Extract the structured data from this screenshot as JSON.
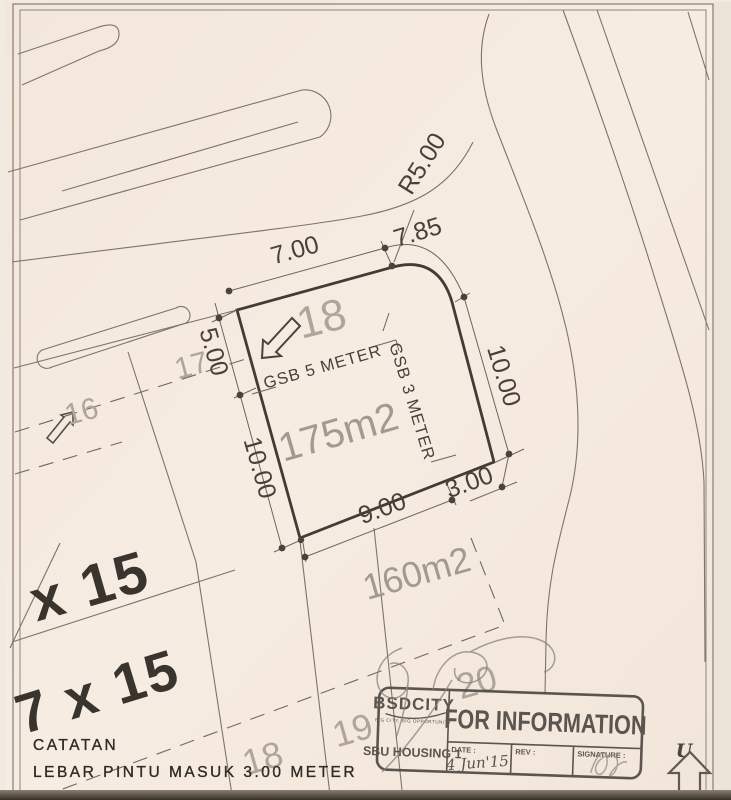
{
  "dims": {
    "top": "7.00",
    "arc": "7.85",
    "radius": "R5.00",
    "left_upper": "5.00",
    "left_lower": "10.00",
    "right": "10.00",
    "bottom": "9.00",
    "bottom_right": "3.00"
  },
  "plot": {
    "number": "18",
    "area": "175m2",
    "gsb_front": "GSB 5 METER",
    "gsb_side": "GSB 3 METER"
  },
  "lots": {
    "l16": "16",
    "l17": "17",
    "l18_lower": "18",
    "l19": "19",
    "l20": "20",
    "area_lower": "160m2",
    "size_row_upper": "x 15",
    "size_row_lower": "7 x 15"
  },
  "note": {
    "title": "CATATAN",
    "body": "LEBAR PINTU MASUK 3.00 METER"
  },
  "north": {
    "label": "U"
  },
  "stamp": {
    "brand": "BSDCITY",
    "tagline": "BIG CITY, BIG OPPORTUNITY",
    "unit": "SBU HOUSING 1",
    "status": "FOR INFORMATION",
    "date_label": "DATE :",
    "date_value": "4 Jun'15",
    "rev_label": "REV :",
    "signature_label": "SIGNATURE :"
  },
  "colors": {
    "paper": "#f6ebe1",
    "ink": "#46413a",
    "line": "#7c746a",
    "faint_label": "#aba295",
    "stamp_ink": "#4b4640"
  }
}
